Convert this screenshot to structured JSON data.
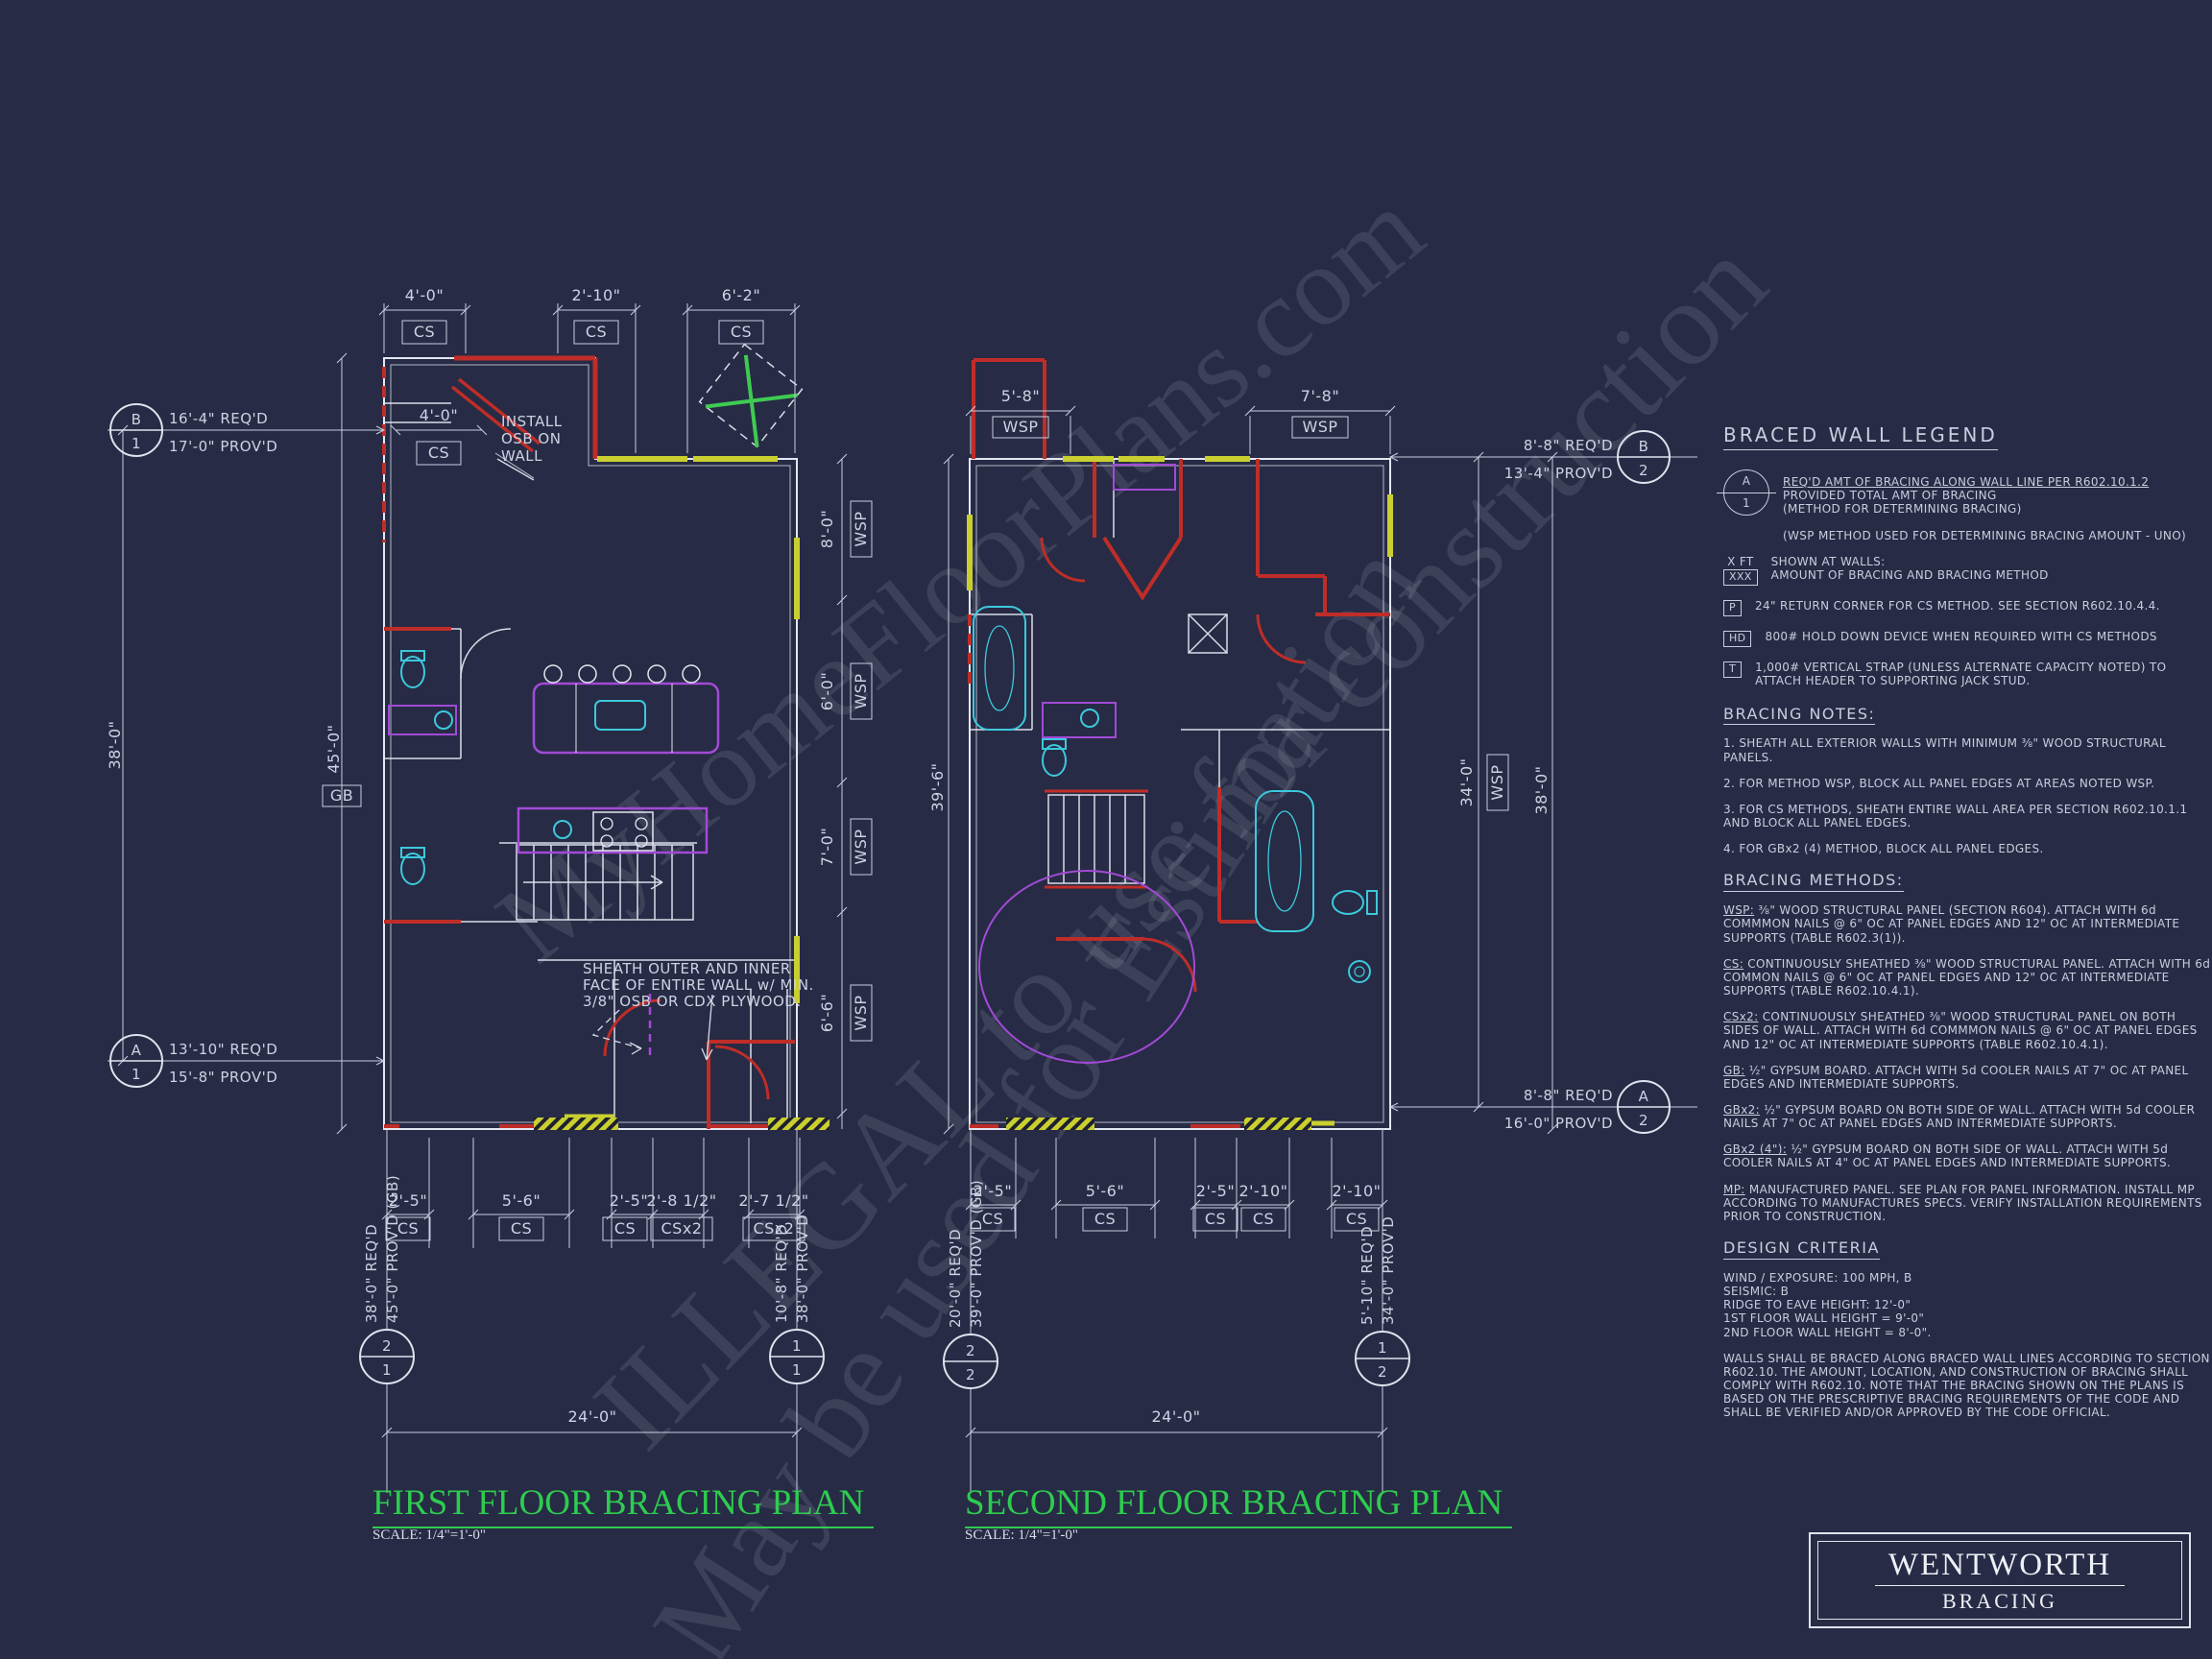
{
  "watermarks": {
    "wm1": "MyHomeFloorPlans.com",
    "wm2": "ILLEGAL to use for construction",
    "wm3": "May be used for Estimation"
  },
  "first_plan": {
    "title": "FIRST FLOOR BRACING PLAN",
    "scale": "SCALE: 1/4\"=1'-0\"",
    "top_dims": [
      {
        "len": "4'-0\"",
        "m": "CS"
      },
      {
        "len": "2'-10\"",
        "m": "CS"
      },
      {
        "len": "6'-2\"",
        "m": "CS"
      }
    ],
    "inner_dim": {
      "len": "4'-0\"",
      "m": "CS"
    },
    "osb_note": {
      "l1": "INSTALL",
      "l2": "OSB ON",
      "l3": "WALL"
    },
    "sheath_note": {
      "l1": "SHEATH OUTER AND INNER",
      "l2": "FACE OF ENTIRE WALL w/ MIN.",
      "l3": "3/8\" OSB OR CDX PLYWOOD."
    },
    "left_overall": "38'-0\"",
    "left_inner": "45'-0\"",
    "left_inner_method": "GB",
    "right_dims": [
      {
        "len": "8'-0\"",
        "m": "WSP"
      },
      {
        "len": "6'-0\"",
        "m": "WSP"
      },
      {
        "len": "7'-0\"",
        "m": "WSP"
      },
      {
        "len": "6'-6\"",
        "m": "WSP"
      }
    ],
    "bottom_dims": [
      {
        "len": "2'-5\"",
        "m": "CS"
      },
      {
        "len": "5'-6\"",
        "m": "CS"
      },
      {
        "len": "2'-5\"",
        "m": "CS"
      },
      {
        "len": "2'-8 1/2\"",
        "m": "CSx2"
      },
      {
        "len": "2'-7 1/2\"",
        "m": "CSx2"
      }
    ],
    "overall_width": "24'-0\"",
    "markers": {
      "b1": {
        "top": "B",
        "bot": "1",
        "req": "16'-4\" REQ'D",
        "prov": "17'-0\" PROV'D"
      },
      "a1": {
        "top": "A",
        "bot": "1",
        "req": "13'-10\" REQ'D",
        "prov": "15'-8\" PROV'D"
      },
      "v21": {
        "top": "2",
        "bot": "1",
        "req": "38'-0\" REQ'D",
        "prov": "45'-0\" PROV'D (GB)"
      },
      "v11": {
        "top": "1",
        "bot": "1",
        "req": "10'-8\" REQ'D",
        "prov": "38'-0\" PROV'D"
      }
    }
  },
  "second_plan": {
    "title": "SECOND FLOOR BRACING PLAN",
    "scale": "SCALE: 1/4\"=1'-0\"",
    "top_dims": [
      {
        "len": "5'-8\"",
        "m": "WSP"
      },
      {
        "len": "7'-8\"",
        "m": "WSP"
      }
    ],
    "left_overall": "39'-6\"",
    "right_inner": {
      "len": "34'-0\"",
      "m": "WSP"
    },
    "right_overall": "38'-0\"",
    "bottom_dims": [
      {
        "len": "2'-5\"",
        "m": "CS"
      },
      {
        "len": "5'-6\"",
        "m": "CS"
      },
      {
        "len": "2'-5\"",
        "m": "CS"
      },
      {
        "len": "2'-10\"",
        "m": "CS"
      },
      {
        "len": "2'-10\"",
        "m": "CS"
      }
    ],
    "overall_width": "24'-0\"",
    "markers": {
      "b2": {
        "top": "B",
        "bot": "2",
        "req": "8'-8\" REQ'D",
        "prov": "13'-4\" PROV'D"
      },
      "a2": {
        "top": "A",
        "bot": "2",
        "req": "8'-8\" REQ'D",
        "prov": "16'-0\" PROV'D"
      },
      "v22": {
        "top": "2",
        "bot": "2",
        "req": "20'-0\" REQ'D",
        "prov": "39'-0\" PROV'D (GB)"
      },
      "v12": {
        "top": "1",
        "bot": "2",
        "req": "5'-10\" REQ'D",
        "prov": "34'-0\" PROV'D"
      }
    }
  },
  "legend": {
    "title": "BRACED WALL LEGEND",
    "ab": {
      "top": "A",
      "bot": "1",
      "line1": "REQ'D AMT OF BRACING ALONG WALL LINE PER R602.10.1.2",
      "line2": "PROVIDED TOTAL AMT OF BRACING",
      "line3": "(METHOD FOR DETERMINING BRACING)"
    },
    "wsp_note": "(WSP METHOD USED FOR DETERMINING BRACING AMOUNT - UNO)",
    "xft": {
      "label": "X FT",
      "box": "XXX",
      "line1": "SHOWN AT WALLS:",
      "line2": "AMOUNT OF BRACING AND BRACING METHOD"
    },
    "p": {
      "box": "P",
      "text": "24\" RETURN CORNER FOR CS METHOD.  SEE SECTION R602.10.4.4."
    },
    "hd": {
      "box": "HD",
      "text": "800# HOLD DOWN DEVICE WHEN REQUIRED WITH CS METHODS"
    },
    "t": {
      "box": "T",
      "text": "1,000# VERTICAL STRAP (UNLESS ALTERNATE CAPACITY NOTED) TO ATTACH HEADER TO SUPPORTING JACK STUD."
    },
    "notes_title": "BRACING NOTES:",
    "notes": [
      "1. SHEATH ALL EXTERIOR WALLS WITH MINIMUM ⅜\" WOOD STRUCTURAL PANELS.",
      "2. FOR METHOD WSP, BLOCK ALL PANEL EDGES AT AREAS NOTED WSP.",
      "3. FOR CS METHODS, SHEATH ENTIRE WALL AREA PER SECTION R602.10.1.1 AND BLOCK ALL PANEL EDGES.",
      "4. FOR GBx2 (4) METHOD, BLOCK ALL PANEL EDGES."
    ],
    "methods_title": "BRACING METHODS:",
    "methods": [
      {
        "key": "WSP:",
        "text": "⅜\" WOOD STRUCTURAL PANEL (SECTION R604). ATTACH WITH 6d COMMMON NAILS @ 6\" OC AT PANEL EDGES AND 12\" OC AT INTERMEDIATE SUPPORTS (TABLE R602.3(1))."
      },
      {
        "key": "CS:",
        "text": "CONTINUOUSLY SHEATHED ⅜\" WOOD STRUCTURAL PANEL. ATTACH WITH 6d COMMON NAILS @ 6\" OC AT PANEL EDGES AND 12\" OC AT INTERMEDIATE SUPPORTS (TABLE R602.10.4.1)."
      },
      {
        "key": "CSx2:",
        "text": "CONTINUOUSLY SHEATHED ⅜\" WOOD STRUCTURAL PANEL ON BOTH SIDES OF WALL. ATTACH WITH 6d COMMMON NAILS @ 6\" OC AT PANEL EDGES AND 12\" OC AT INTERMEDIATE SUPPORTS (TABLE R602.10.4.1)."
      },
      {
        "key": "GB:",
        "text": "½\" GYPSUM BOARD. ATTACH WITH 5d COOLER NAILS AT 7\" OC AT PANEL EDGES AND INTERMEDIATE SUPPORTS."
      },
      {
        "key": "GBx2:",
        "text": "½\" GYPSUM BOARD ON BOTH SIDE OF WALL. ATTACH WITH 5d COOLER NAILS AT 7\" OC AT PANEL EDGES AND INTERMEDIATE SUPPORTS."
      },
      {
        "key": "GBx2 (4\"):",
        "text": "½\" GYPSUM BOARD ON BOTH SIDE OF WALL. ATTACH WITH 5d COOLER NAILS AT 4\" OC AT PANEL EDGES AND INTERMEDIATE SUPPORTS."
      },
      {
        "key": "MP:",
        "text": "MANUFACTURED PANEL. SEE PLAN FOR PANEL INFORMATION. INSTALL MP ACCORDING TO MANUFACTURES SPECS. VERIFY INSTALLATION REQUIREMENTS PRIOR TO CONSTRUCTION."
      }
    ],
    "design_title": "DESIGN CRITERIA",
    "criteria": [
      "WIND / EXPOSURE:  100 MPH, B",
      "SEISMIC:  B",
      "RIDGE TO EAVE HEIGHT: 12'-0\"",
      "1ST FLOOR WALL HEIGHT = 9'-0\"",
      "2ND FLOOR WALL HEIGHT = 8'-0\"."
    ],
    "design_para": "WALLS SHALL BE BRACED ALONG BRACED WALL LINES ACCORDING TO SECTION R602.10. THE AMOUNT, LOCATION, AND CONSTRUCTION OF BRACING SHALL COMPLY WITH R602.10. NOTE THAT THE BRACING SHOWN ON THE PLANS IS BASED ON THE PRESCRIPTIVE BRACING REQUIREMENTS OF THE CODE AND SHALL BE VERIFIED AND/OR APPROVED BY THE CODE OFFICIAL."
  },
  "title_block": {
    "name": "WENTWORTH",
    "sub": "BRACING"
  }
}
